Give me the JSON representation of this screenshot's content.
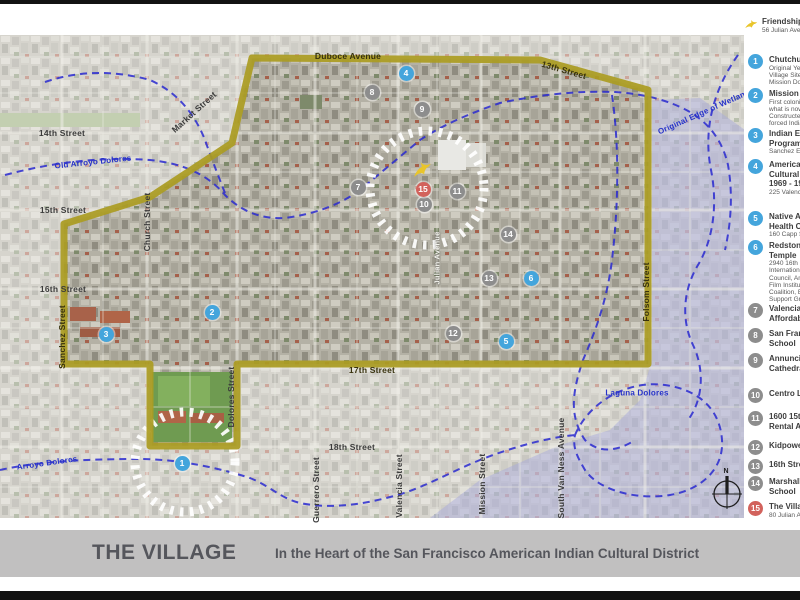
{
  "frame": {
    "title": "THE VILLAGE",
    "subtitle": "In the Heart of the San Francisco American Indian Cultural District"
  },
  "colors": {
    "boundary": "#ab9c22",
    "marker_blue": "#44a5dc",
    "marker_gray": "#8d8d8d",
    "marker_red": "#d2625c",
    "creek": "#2a2ad0",
    "accent_yellow": "#e9c52b"
  },
  "legend": {
    "intro": {
      "icon": "hummingbird-icon",
      "title": "Friendship House",
      "address": "56 Julian Avenue"
    },
    "items": [
      {
        "n": "1",
        "color": "blue",
        "top": 50,
        "title": [
          "Chutchui"
        ],
        "sub": [
          "Original Yelamu",
          "Village Site, near",
          "Mission Dolores"
        ]
      },
      {
        "n": "2",
        "color": "blue",
        "top": 84,
        "title": [
          "Mission Dolores"
        ],
        "sub": [
          "First colonization site of",
          "what is now San Francisco.",
          "Constructed with",
          "forced Indian labor"
        ]
      },
      {
        "n": "3",
        "color": "blue",
        "top": 124,
        "title": [
          "Indian Education",
          "Program"
        ],
        "sub": [
          "Sanchez Elementary"
        ]
      },
      {
        "n": "4",
        "color": "blue",
        "top": 155,
        "title": [
          "American Indian",
          "Cultural Center",
          "1969 - 1989"
        ],
        "sub": [
          "225 Valencia Street"
        ]
      },
      {
        "n": "5",
        "color": "blue",
        "top": 207,
        "title": [
          "Native American",
          "Health Center"
        ],
        "sub": [
          "160 Capp Street"
        ]
      },
      {
        "n": "6",
        "color": "blue",
        "top": 236,
        "title": [
          "Redstone Labor",
          "Temple"
        ],
        "sub": [
          "2940 16th Street.",
          "International Indian Treaty",
          "Council, American Indian",
          "Film Institute, American Indian",
          "Coalition, Bi-Annual Indian",
          "Support Group"
        ]
      },
      {
        "n": "7",
        "color": "gray",
        "top": 299,
        "title": [
          "Valencia Gardens",
          "Affordable Housing"
        ],
        "sub": []
      },
      {
        "n": "8",
        "color": "gray",
        "top": 324,
        "title": [
          "San Francisco Friends",
          "School"
        ],
        "sub": []
      },
      {
        "n": "9",
        "color": "gray",
        "top": 349,
        "title": [
          "Annunciation",
          "Cathedral"
        ],
        "sub": []
      },
      {
        "n": "10",
        "color": "gray",
        "top": 384,
        "title": [
          "Centro Latino"
        ],
        "sub": []
      },
      {
        "n": "11",
        "color": "gray",
        "top": 407,
        "title": [
          "1600 15th Street",
          "Rental Apartments"
        ],
        "sub": []
      },
      {
        "n": "12",
        "color": "gray",
        "top": 436,
        "title": [
          "Kidpower Park"
        ],
        "sub": []
      },
      {
        "n": "13",
        "color": "gray",
        "top": 455,
        "title": [
          "16th Street BART Plaza"
        ],
        "sub": []
      },
      {
        "n": "14",
        "color": "gray",
        "top": 472,
        "title": [
          "Marshall Elementary",
          "School"
        ],
        "sub": []
      },
      {
        "n": "15",
        "color": "red",
        "top": 497,
        "title": [
          "The Village"
        ],
        "sub": [
          "80 Julian Avenue"
        ]
      }
    ]
  },
  "map": {
    "compass_label": "N",
    "village_icon": "hummingbird-icon",
    "markers": [
      {
        "n": "1",
        "color": "blue",
        "x": 182,
        "y": 463
      },
      {
        "n": "2",
        "color": "blue",
        "x": 212,
        "y": 312
      },
      {
        "n": "3",
        "color": "blue",
        "x": 106,
        "y": 334
      },
      {
        "n": "4",
        "color": "blue",
        "x": 406,
        "y": 73
      },
      {
        "n": "5",
        "color": "blue",
        "x": 506,
        "y": 341
      },
      {
        "n": "6",
        "color": "blue",
        "x": 531,
        "y": 278
      },
      {
        "n": "7",
        "color": "gray",
        "x": 358,
        "y": 187
      },
      {
        "n": "8",
        "color": "gray",
        "x": 372,
        "y": 92
      },
      {
        "n": "9",
        "color": "gray",
        "x": 422,
        "y": 109
      },
      {
        "n": "10",
        "color": "gray",
        "x": 424,
        "y": 204
      },
      {
        "n": "11",
        "color": "gray",
        "x": 457,
        "y": 191
      },
      {
        "n": "12",
        "color": "gray",
        "x": 453,
        "y": 333
      },
      {
        "n": "13",
        "color": "gray",
        "x": 489,
        "y": 278
      },
      {
        "n": "14",
        "color": "gray",
        "x": 508,
        "y": 234
      },
      {
        "n": "15",
        "color": "red",
        "x": 423,
        "y": 189
      }
    ],
    "labels": [
      {
        "text": "Duboce Avenue",
        "x": 348,
        "y": 56,
        "rot": 0,
        "cls": "onb"
      },
      {
        "text": "13th Street",
        "x": 564,
        "y": 70,
        "rot": 16,
        "cls": "onb"
      },
      {
        "text": "17th Street",
        "x": 372,
        "y": 370,
        "rot": 0,
        "cls": "onb"
      },
      {
        "text": "Sanchez Street",
        "x": 62,
        "y": 337,
        "rot": -90,
        "cls": "onb"
      },
      {
        "text": "Folsom Street",
        "x": 646,
        "y": 292,
        "rot": -90,
        "cls": "onb"
      },
      {
        "text": "14th Street",
        "x": 62,
        "y": 133,
        "rot": 0,
        "cls": "dark"
      },
      {
        "text": "15th Street",
        "x": 63,
        "y": 210,
        "rot": 0,
        "cls": "dark"
      },
      {
        "text": "16th Street",
        "x": 63,
        "y": 289,
        "rot": 0,
        "cls": "dark"
      },
      {
        "text": "18th Street",
        "x": 352,
        "y": 447,
        "rot": 0,
        "cls": "dark"
      },
      {
        "text": "Market Street",
        "x": 194,
        "y": 112,
        "rot": -42,
        "cls": "dark"
      },
      {
        "text": "Church Street",
        "x": 147,
        "y": 222,
        "rot": -90,
        "cls": "dark"
      },
      {
        "text": "Dolores Street",
        "x": 231,
        "y": 397,
        "rot": -90,
        "cls": "dark"
      },
      {
        "text": "Guerrero Street",
        "x": 316,
        "y": 490,
        "rot": -90,
        "cls": "dark"
      },
      {
        "text": "Valencia Street",
        "x": 399,
        "y": 486,
        "rot": -90,
        "cls": "dark"
      },
      {
        "text": "Mission Street",
        "x": 482,
        "y": 484,
        "rot": -90,
        "cls": "dark"
      },
      {
        "text": "South Van Ness Avenue",
        "x": 561,
        "y": 468,
        "rot": -90,
        "cls": "dark"
      },
      {
        "text": "Julian Avenue",
        "x": 437,
        "y": 258,
        "rot": -90,
        "cls": "white"
      },
      {
        "text": "Old Arroyo Dolores",
        "x": 93,
        "y": 162,
        "rot": -6,
        "cls": "blue"
      },
      {
        "text": "Arroyo Dolores",
        "x": 47,
        "y": 463,
        "rot": -8,
        "cls": "blue"
      },
      {
        "text": "Original Edge of Wetlands",
        "x": 706,
        "y": 111,
        "rot": -24,
        "cls": "blue"
      },
      {
        "text": "Laguna Dolores",
        "x": 637,
        "y": 393,
        "rot": 0,
        "cls": "blue"
      }
    ]
  }
}
